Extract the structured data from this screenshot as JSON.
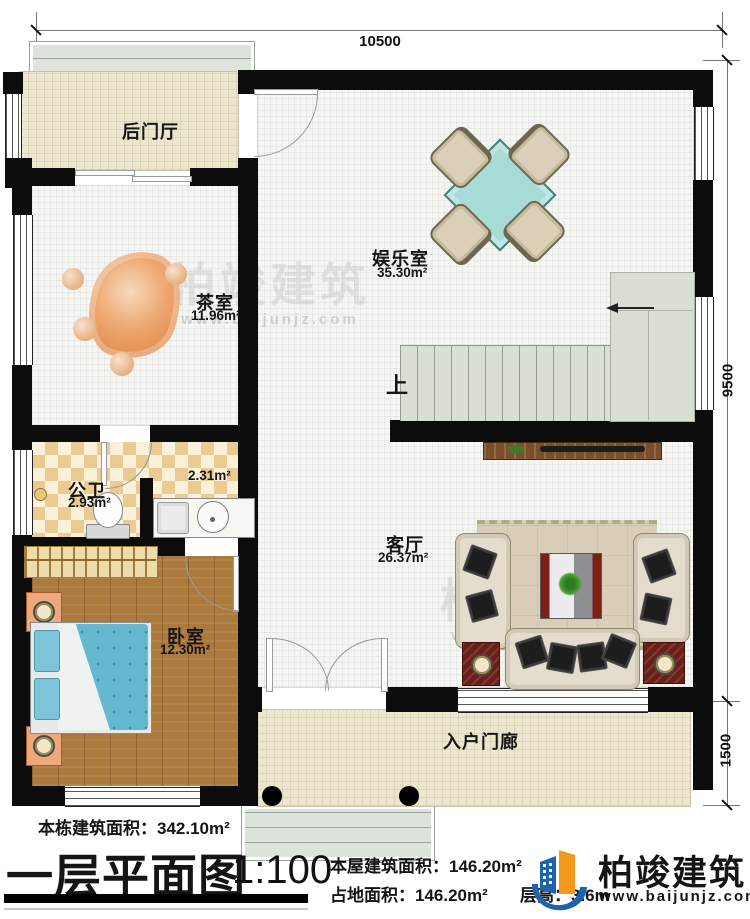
{
  "dims": {
    "top": "10500",
    "right_main": "9500",
    "right_lower": "1500"
  },
  "rooms": {
    "back_hall": {
      "name": "后门厅"
    },
    "tea": {
      "name": "茶室",
      "area": "11.96m²"
    },
    "fun": {
      "name": "娱乐室",
      "area": "35.30m²"
    },
    "wc": {
      "name": "公卫",
      "area": "2.93m²"
    },
    "wc2": {
      "area": "2.31m²"
    },
    "bedroom": {
      "name": "卧室",
      "area": "12.30m²"
    },
    "living": {
      "name": "客厅",
      "area": "26.37m²"
    },
    "porch": {
      "name": "入户门廊"
    },
    "stairs": {
      "up": "上"
    }
  },
  "footer": {
    "total_area": "本栋建筑面积：342.10m²",
    "title": "一层平面图",
    "scale": "1:100",
    "house_area": "本屋建筑面积：146.20m²",
    "land_area": "占地面积：146.20m²",
    "floor_height": "层高：3.6m"
  },
  "brand": {
    "name": "柏竣建筑",
    "site": "www.baijunjz.com"
  },
  "watermark": {
    "text": "柏竣建筑",
    "site": "www.baijunjz.com"
  },
  "colors": {
    "wall": "#0c0c0c",
    "logo_blue": "#1e63ad",
    "logo_orange": "#f5991d"
  }
}
